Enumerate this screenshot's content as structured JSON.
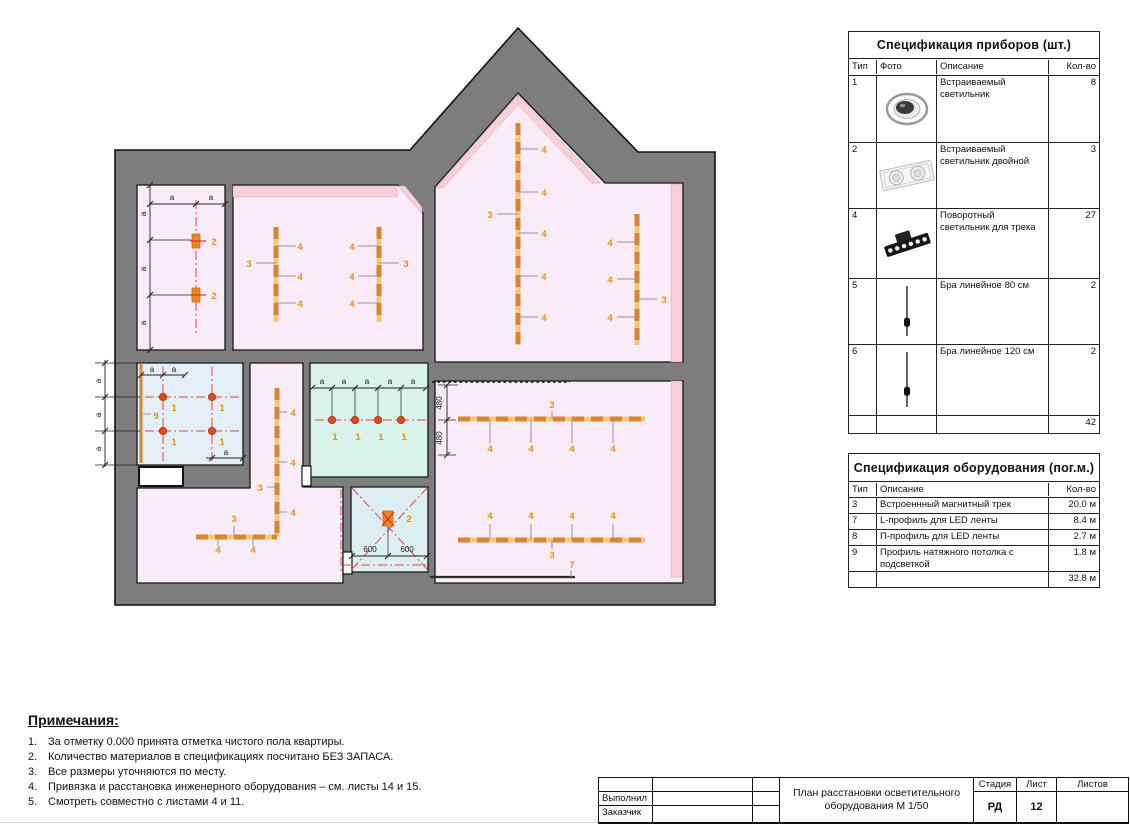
{
  "plan": {
    "colors": {
      "wall": "#7d7d7d",
      "outline": "#111111",
      "pink": "#f9ecf8",
      "rose": "#f7cfd8",
      "cyan": "#d9f3ea",
      "blue": "#e3eef7",
      "blue2": "#ddeff3",
      "track": "#d9852e",
      "track_light": "#f3c87c",
      "orange": "#e8920c",
      "red": "#e34545",
      "dot": "#e0481f",
      "stem": "#9b8fa3"
    },
    "outer": "115,150 410,150 518,28 638,152 715,152 715,605 115,605",
    "rooms": [
      {
        "id": "top-left-room",
        "f": "pink",
        "p": "137,185 225,185 225,350 137,350"
      },
      {
        "id": "room-2",
        "f": "pink",
        "p": "233,185 398,185 423,213 423,350 233,350"
      },
      {
        "id": "gable-room",
        "f": "pink",
        "p": "518,93 605,183 683,183 683,362 435,362 435,187"
      },
      {
        "id": "middle-room",
        "f": "cyan",
        "p": "310,363 428,363 428,477 310,477"
      },
      {
        "id": "corner-room",
        "f": "blue",
        "p": "137,363 243,363 243,465 137,465"
      },
      {
        "id": "x-room",
        "f": "blue2",
        "p": "351,487 428,487 428,572 351,572"
      },
      {
        "id": "corridor",
        "f": "pink",
        "p": "250,363 303,363 303,487 343,487 343,583 137,583 137,488 250,488"
      },
      {
        "id": "bottom-right-room",
        "f": "pink",
        "p": "435,381 683,381 683,583 435,583"
      }
    ],
    "strips": [
      "233,186 397,186 397,197 233,197",
      "398,186 405,186 422,207 422,214",
      "436,188 518,95 518,105 443,188",
      "518,95 600,183 592,183 518,105",
      "671,184 682,184 682,362 671,362",
      "671,381 682,381 682,577 671,577"
    ],
    "doors": [
      {
        "x": 139,
        "y": 467,
        "w": 44,
        "h": 19,
        "sw": 2
      },
      {
        "x": 343,
        "y": 552,
        "w": 9,
        "h": 22,
        "sw": 1.2
      },
      {
        "x": 302,
        "y": 466,
        "w": 9,
        "h": 20,
        "sw": 1.2
      }
    ],
    "dashdot": [
      [
        196,
        200,
        196,
        335
      ],
      [
        163,
        367,
        163,
        461
      ],
      [
        212,
        367,
        212,
        461
      ],
      [
        145,
        397,
        240,
        397
      ],
      [
        145,
        431,
        240,
        431
      ],
      [
        315,
        420,
        428,
        420
      ],
      [
        352,
        488,
        427,
        569
      ],
      [
        352,
        569,
        427,
        488
      ],
      [
        341,
        489,
        341,
        573
      ],
      [
        344,
        565,
        427,
        565
      ]
    ],
    "dotted": [
      [
        432,
        382,
        570,
        382
      ]
    ],
    "dark": [
      [
        430,
        577,
        575,
        577
      ]
    ],
    "tracks": [
      [
        276,
        227,
        276,
        322
      ],
      [
        379,
        227,
        379,
        322
      ],
      [
        518,
        123,
        518,
        345
      ],
      [
        637,
        214,
        637,
        345
      ],
      [
        277,
        388,
        277,
        537
      ],
      [
        196,
        537,
        277,
        537
      ],
      [
        458,
        419,
        645,
        419
      ],
      [
        458,
        540,
        645,
        540
      ]
    ],
    "profile9": [
      141,
      363,
      141,
      463
    ],
    "stems": [
      [
        276,
        246,
        296,
        246
      ],
      [
        276,
        276,
        296,
        276
      ],
      [
        276,
        303,
        296,
        303
      ],
      [
        256,
        263,
        276,
        263
      ],
      [
        358,
        246,
        379,
        246
      ],
      [
        358,
        276,
        379,
        276
      ],
      [
        358,
        303,
        379,
        303
      ],
      [
        379,
        263,
        399,
        263
      ],
      [
        518,
        149,
        538,
        149
      ],
      [
        518,
        192,
        538,
        192
      ],
      [
        518,
        233,
        538,
        233
      ],
      [
        518,
        276,
        538,
        276
      ],
      [
        518,
        317,
        538,
        317
      ],
      [
        497,
        214,
        518,
        214
      ],
      [
        617,
        242,
        637,
        242
      ],
      [
        617,
        279,
        637,
        279
      ],
      [
        617,
        317,
        637,
        317
      ],
      [
        637,
        299,
        657,
        299
      ],
      [
        277,
        412,
        287,
        412
      ],
      [
        277,
        462,
        287,
        462
      ],
      [
        277,
        512,
        287,
        512
      ],
      [
        267,
        487,
        277,
        487
      ],
      [
        218,
        537,
        218,
        546
      ],
      [
        253,
        537,
        253,
        546
      ],
      [
        234,
        526,
        234,
        537
      ],
      [
        490,
        419,
        490,
        443
      ],
      [
        531,
        419,
        531,
        443
      ],
      [
        572,
        419,
        572,
        443
      ],
      [
        613,
        419,
        613,
        443
      ],
      [
        552,
        411,
        552,
        419
      ],
      [
        490,
        524,
        490,
        540
      ],
      [
        531,
        524,
        531,
        540
      ],
      [
        572,
        524,
        572,
        540
      ],
      [
        613,
        524,
        613,
        540
      ],
      [
        552,
        540,
        552,
        549
      ],
      [
        571,
        570,
        571,
        577
      ],
      [
        143,
        414,
        151,
        414
      ]
    ],
    "thin": [
      [
        95,
        363,
        140,
        363
      ],
      [
        95,
        397,
        140,
        397
      ],
      [
        95,
        431,
        140,
        431
      ],
      [
        95,
        465,
        140,
        465
      ],
      [
        150,
        240,
        191,
        240
      ],
      [
        150,
        295,
        191,
        295
      ],
      [
        332,
        388,
        332,
        416
      ],
      [
        355,
        388,
        355,
        416
      ],
      [
        378,
        388,
        378,
        416
      ],
      [
        401,
        388,
        401,
        416
      ],
      [
        438,
        385,
        458,
        385
      ],
      [
        438,
        420,
        456,
        420
      ],
      [
        438,
        455,
        456,
        455
      ],
      [
        388,
        527,
        388,
        556
      ]
    ],
    "dims": [
      {
        "l": [
          150,
          204,
          225,
          204
        ],
        "t": [
          [
            150,
            204
          ],
          [
            196,
            204
          ],
          [
            225,
            204
          ]
        ]
      },
      {
        "l": [
          150,
          185,
          150,
          350
        ],
        "t": [
          [
            150,
            185
          ],
          [
            150,
            240
          ],
          [
            150,
            295
          ],
          [
            150,
            350
          ]
        ]
      },
      {
        "l": [
          105,
          360,
          105,
          467
        ],
        "t": [
          [
            105,
            363
          ],
          [
            105,
            397
          ],
          [
            105,
            431
          ],
          [
            105,
            465
          ]
        ]
      },
      {
        "l": [
          141,
          375,
          185,
          375
        ],
        "t": [
          [
            141,
            375
          ],
          [
            163,
            375
          ],
          [
            185,
            375
          ]
        ]
      },
      {
        "l": [
          206,
          458,
          243,
          458
        ],
        "t": [
          [
            212,
            458
          ],
          [
            243,
            458
          ]
        ]
      },
      {
        "l": [
          312,
          388,
          426,
          388
        ],
        "t": [
          [
            312,
            388
          ],
          [
            332,
            388
          ],
          [
            355,
            388
          ],
          [
            378,
            388
          ],
          [
            401,
            388
          ],
          [
            426,
            388
          ]
        ]
      },
      {
        "l": [
          447,
          385,
          447,
          455
        ],
        "t": [
          [
            447,
            385
          ],
          [
            447,
            420
          ],
          [
            447,
            455
          ]
        ]
      },
      {
        "l": [
          352,
          556,
          427,
          556
        ],
        "t": [
          [
            352,
            556
          ],
          [
            388,
            556
          ],
          [
            427,
            556
          ]
        ]
      }
    ],
    "dots": [
      [
        163,
        397
      ],
      [
        212,
        397
      ],
      [
        163,
        431
      ],
      [
        212,
        431
      ],
      [
        332,
        420
      ],
      [
        355,
        420
      ],
      [
        378,
        420
      ],
      [
        401,
        420
      ]
    ],
    "type2": [
      {
        "x": 192,
        "y": 234,
        "w": 8,
        "h": 14
      },
      {
        "x": 192,
        "y": 288,
        "w": 8,
        "h": 14
      },
      {
        "x": 383,
        "y": 511,
        "w": 10,
        "h": 15
      }
    ],
    "redmarks": [
      [
        190,
        241,
        206,
        241
      ],
      [
        190,
        295,
        206,
        295
      ],
      [
        382,
        512,
        394,
        526
      ],
      [
        394,
        512,
        382,
        526
      ]
    ],
    "labels": [
      {
        "t": "2",
        "x": 214,
        "y": 245,
        "c": "o"
      },
      {
        "t": "2",
        "x": 214,
        "y": 299,
        "c": "o"
      },
      {
        "t": "4",
        "x": 300,
        "y": 250,
        "c": "o"
      },
      {
        "t": "4",
        "x": 300,
        "y": 280,
        "c": "o"
      },
      {
        "t": "4",
        "x": 300,
        "y": 307,
        "c": "o"
      },
      {
        "t": "3",
        "x": 249,
        "y": 267,
        "c": "o"
      },
      {
        "t": "4",
        "x": 352,
        "y": 250,
        "c": "o"
      },
      {
        "t": "4",
        "x": 352,
        "y": 280,
        "c": "o"
      },
      {
        "t": "4",
        "x": 352,
        "y": 307,
        "c": "o"
      },
      {
        "t": "3",
        "x": 406,
        "y": 267,
        "c": "o"
      },
      {
        "t": "4",
        "x": 544,
        "y": 153,
        "c": "o"
      },
      {
        "t": "4",
        "x": 544,
        "y": 196,
        "c": "o"
      },
      {
        "t": "4",
        "x": 544,
        "y": 237,
        "c": "o"
      },
      {
        "t": "4",
        "x": 544,
        "y": 280,
        "c": "o"
      },
      {
        "t": "4",
        "x": 544,
        "y": 321,
        "c": "o"
      },
      {
        "t": "3",
        "x": 490,
        "y": 218,
        "c": "o"
      },
      {
        "t": "4",
        "x": 610,
        "y": 246,
        "c": "o"
      },
      {
        "t": "4",
        "x": 610,
        "y": 283,
        "c": "o"
      },
      {
        "t": "4",
        "x": 610,
        "y": 321,
        "c": "o"
      },
      {
        "t": "3",
        "x": 664,
        "y": 303,
        "c": "o"
      },
      {
        "t": "4",
        "x": 293,
        "y": 416,
        "c": "o"
      },
      {
        "t": "4",
        "x": 293,
        "y": 466,
        "c": "o"
      },
      {
        "t": "4",
        "x": 293,
        "y": 516,
        "c": "o"
      },
      {
        "t": "3",
        "x": 260,
        "y": 491,
        "c": "o"
      },
      {
        "t": "4",
        "x": 218,
        "y": 553,
        "c": "o"
      },
      {
        "t": "4",
        "x": 253,
        "y": 553,
        "c": "o"
      },
      {
        "t": "3",
        "x": 234,
        "y": 522,
        "c": "o"
      },
      {
        "t": "4",
        "x": 490,
        "y": 452,
        "c": "o"
      },
      {
        "t": "4",
        "x": 531,
        "y": 452,
        "c": "o"
      },
      {
        "t": "4",
        "x": 572,
        "y": 452,
        "c": "o"
      },
      {
        "t": "4",
        "x": 613,
        "y": 452,
        "c": "o"
      },
      {
        "t": "3",
        "x": 552,
        "y": 408,
        "c": "o"
      },
      {
        "t": "4",
        "x": 490,
        "y": 519,
        "c": "o"
      },
      {
        "t": "4",
        "x": 531,
        "y": 519,
        "c": "o"
      },
      {
        "t": "4",
        "x": 572,
        "y": 519,
        "c": "o"
      },
      {
        "t": "4",
        "x": 613,
        "y": 519,
        "c": "o"
      },
      {
        "t": "3",
        "x": 552,
        "y": 558,
        "c": "o"
      },
      {
        "t": "7",
        "x": 572,
        "y": 568,
        "c": "o"
      },
      {
        "t": "1",
        "x": 174,
        "y": 411,
        "c": "o"
      },
      {
        "t": "1",
        "x": 222,
        "y": 411,
        "c": "o"
      },
      {
        "t": "1",
        "x": 174,
        "y": 445,
        "c": "o"
      },
      {
        "t": "1",
        "x": 222,
        "y": 445,
        "c": "o"
      },
      {
        "t": "9",
        "x": 156,
        "y": 419,
        "c": "o"
      },
      {
        "t": "1",
        "x": 335,
        "y": 440,
        "c": "o"
      },
      {
        "t": "1",
        "x": 358,
        "y": 440,
        "c": "o"
      },
      {
        "t": "1",
        "x": 381,
        "y": 440,
        "c": "o"
      },
      {
        "t": "1",
        "x": 404,
        "y": 440,
        "c": "o"
      },
      {
        "t": "2",
        "x": 409,
        "y": 522,
        "c": "o"
      },
      {
        "t": "a",
        "x": 172,
        "y": 200,
        "c": "k"
      },
      {
        "t": "a",
        "x": 211,
        "y": 200,
        "c": "k"
      },
      {
        "t": "a",
        "x": 146,
        "y": 214,
        "c": "k",
        "r": -90
      },
      {
        "t": "a",
        "x": 146,
        "y": 269,
        "c": "k",
        "r": -90
      },
      {
        "t": "a",
        "x": 146,
        "y": 323,
        "c": "k",
        "r": -90
      },
      {
        "t": "a",
        "x": 101,
        "y": 381,
        "c": "k",
        "r": -90
      },
      {
        "t": "a",
        "x": 101,
        "y": 415,
        "c": "k",
        "r": -90
      },
      {
        "t": "a",
        "x": 101,
        "y": 449,
        "c": "k",
        "r": -90
      },
      {
        "t": "a",
        "x": 152,
        "y": 372,
        "c": "k"
      },
      {
        "t": "a",
        "x": 174,
        "y": 372,
        "c": "k"
      },
      {
        "t": "a",
        "x": 226,
        "y": 455,
        "c": "k"
      },
      {
        "t": "a",
        "x": 322,
        "y": 384,
        "c": "k"
      },
      {
        "t": "a",
        "x": 344,
        "y": 384,
        "c": "k"
      },
      {
        "t": "a",
        "x": 367,
        "y": 384,
        "c": "k"
      },
      {
        "t": "a",
        "x": 390,
        "y": 384,
        "c": "k"
      },
      {
        "t": "a",
        "x": 413,
        "y": 384,
        "c": "k"
      },
      {
        "t": "480",
        "x": 442,
        "y": 403,
        "c": "k",
        "r": -90
      },
      {
        "t": "480",
        "x": 442,
        "y": 438,
        "c": "k",
        "r": -90
      },
      {
        "t": "600",
        "x": 370,
        "y": 552,
        "c": "k"
      },
      {
        "t": "600",
        "x": 407,
        "y": 552,
        "c": "k"
      }
    ]
  },
  "spec_devices": {
    "title": "Спецификация приборов (шт.)",
    "headers": [
      "Тип",
      "Фото",
      "Описание",
      "Кол-во"
    ],
    "rows": [
      {
        "type": "1",
        "photo": "recessed-round",
        "desc": "Встраиваемый светильник",
        "qty": "8",
        "h": 66
      },
      {
        "type": "2",
        "photo": "recessed-double",
        "desc": "Встраиваемый светильник двойной",
        "qty": "3",
        "h": 65
      },
      {
        "type": "4",
        "photo": "track-spot",
        "desc": "Поворотный светильник для трека",
        "qty": "27",
        "h": 69
      },
      {
        "type": "5",
        "photo": "sconce",
        "desc": "Бра линейное 80 см",
        "qty": "2",
        "h": 65
      },
      {
        "type": "6",
        "photo": "sconce",
        "desc": "Бра линейное 120 см",
        "qty": "2",
        "h": 70
      }
    ],
    "total": "42"
  },
  "spec_equipment": {
    "title": "Спецификация оборудования (пог.м.)",
    "headers": [
      "Тип",
      "Описание",
      "Кол-во"
    ],
    "rows": [
      {
        "type": "3",
        "desc": "Встроеннный магнитный трек",
        "qty": "20.0 м",
        "h": 15
      },
      {
        "type": "7",
        "desc": "L-профиль для LED ленты",
        "qty": "8.4 м",
        "h": 15
      },
      {
        "type": "8",
        "desc": "П-профиль для LED ленты",
        "qty": "2.7 м",
        "h": 15
      },
      {
        "type": "9",
        "desc": "Профиль натяжного потолка с подсветкой",
        "qty": "1.8 м",
        "h": 24
      }
    ],
    "total": "32.8 м"
  },
  "notes": {
    "title": "Примечания:",
    "items": [
      "За отметку 0.000 принята отметка чистого пола квартиры.",
      "Количество материалов в спецификациях посчитано БЕЗ ЗАПАСА.",
      "Все размеры уточняются по месту.",
      "Привязка и расстановка инженерного оборудования – см. листы 14 и 15.",
      "Смотреть совместно с листами 4 и 11."
    ]
  },
  "titleblock": {
    "executor_label": "Выполнил",
    "customer_label": "Заказчик",
    "title_line1": "План расстановки осветительного",
    "title_line2": "оборудования М 1/50",
    "stage_label": "Стадия",
    "stage_value": "РД",
    "sheet_label": "Лист",
    "sheet_value": "12",
    "sheets_label": "Листов",
    "sheets_value": ""
  }
}
